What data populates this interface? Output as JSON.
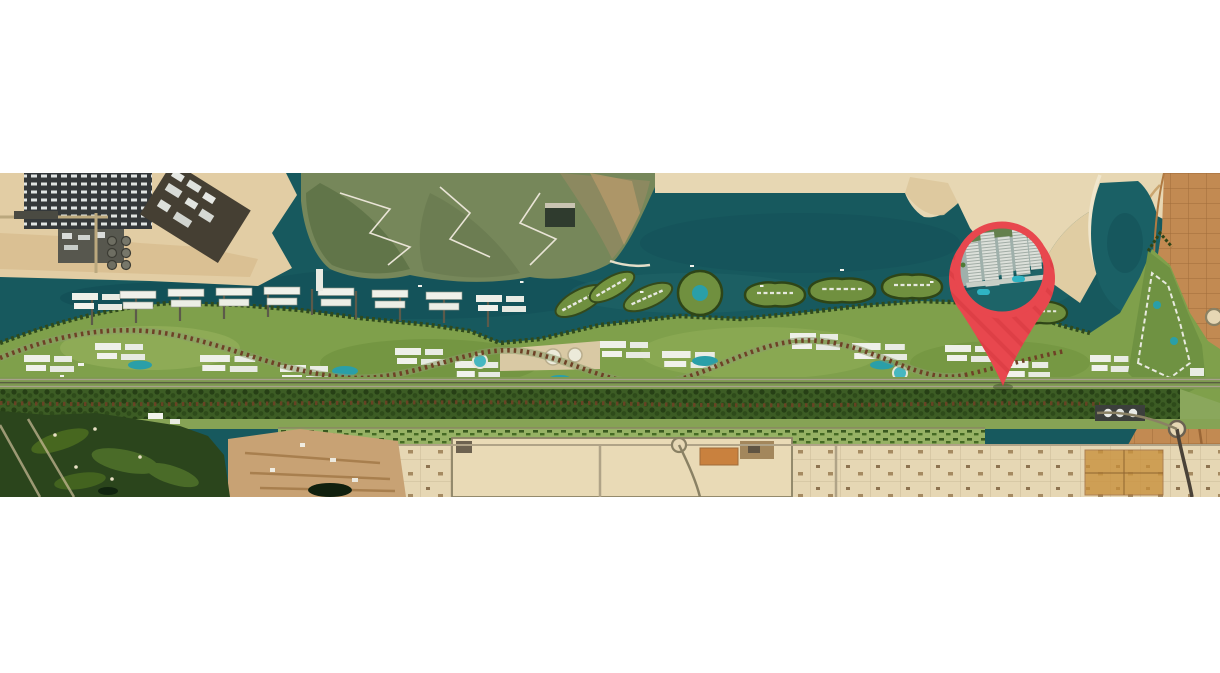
{
  "map": {
    "type": "satellite-masterplan-map",
    "pin": {
      "icon": "location-pin-icon",
      "thumbnail": "waterfront-towers-aerial-render"
    },
    "colors": {
      "page_background": "#ffffff",
      "water": "#17595e",
      "water_deep": "#114d55",
      "water_light": "#26696b",
      "sand_pale": "#e7d7b3",
      "sand_mid": "#d9c398",
      "sand_orange": "#c28a52",
      "sand_construction": "#c8a274",
      "industrial_dark": "#34383a",
      "mangrove_olive": "#76875a",
      "greenbelt": "#7fa04b",
      "boulevard_trees": "#3c5c24",
      "tree_row_red": "#6e4126",
      "golf_course": "#2b451c",
      "building_white": "#eff1e9",
      "road_grey": "#b0a387",
      "pin_red": "#e8474e",
      "pin_red_dark": "#d2353f",
      "pool_blue": "#2fb4c4"
    }
  }
}
